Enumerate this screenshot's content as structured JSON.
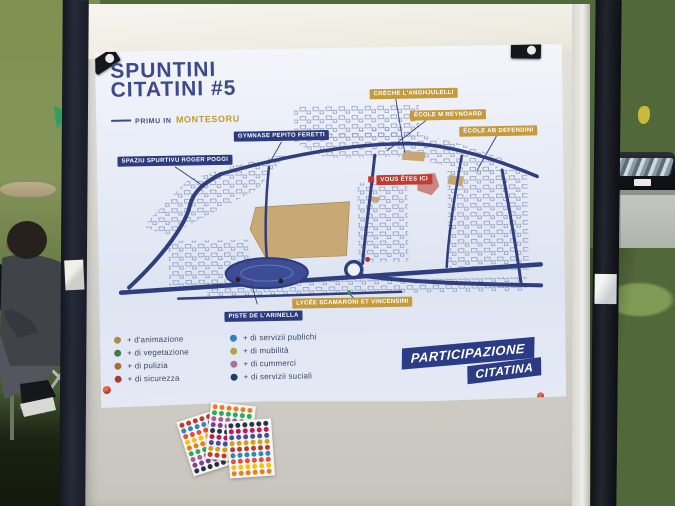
{
  "poster": {
    "title_line1": "SPUNTINI",
    "title_line2": "CITATINI #5",
    "subtitle_prefix": "PRIMU IN",
    "subtitle_place": "MONTESORU",
    "map_labels": [
      {
        "text": "SPAZIU SPURTIVU ROGER POGGI",
        "style": "blue"
      },
      {
        "text": "GYMNASE PEPITO FERETTI",
        "style": "blue"
      },
      {
        "text": "CRÈCHE L'ANGHJULELLI",
        "style": "gold"
      },
      {
        "text": "ÉCOLE M REYNOARD",
        "style": "gold"
      },
      {
        "text": "ÉCOLE AB DEFENDINI",
        "style": "gold"
      },
      {
        "text": "VOUS ÊTES ICI",
        "style": "red"
      },
      {
        "text": "LYCÉE SCAMARONI ET VINCENSINI",
        "style": "gold"
      },
      {
        "text": "PISTE DE L'ARINELLA",
        "style": "blue"
      }
    ],
    "legend_left": [
      {
        "label": "+ d'animazione",
        "color": "#b08948"
      },
      {
        "label": "+ di vegetazione",
        "color": "#3e7a4e"
      },
      {
        "label": "+ di pulizia",
        "color": "#ad6a33"
      },
      {
        "label": "+ di sicurezza",
        "color": "#a33c36"
      }
    ],
    "legend_right": [
      {
        "label": "+ di servizii publichi",
        "color": "#2e7fc2"
      },
      {
        "label": "+ di mubilità",
        "color": "#b3a23f"
      },
      {
        "label": "+ di cummerci",
        "color": "#a9719e"
      },
      {
        "label": "+ di servizii suciali",
        "color": "#1d3a6b"
      }
    ],
    "badge_line1": "PARTICIPAZIONE",
    "badge_line2": "CITATINA",
    "colors": {
      "navy_ink": "#2c3b7d",
      "title_blue": "#3c4a8c",
      "gold": "#c49a3c",
      "red_marker": "#c23d31",
      "track_blue": "#3c4d96",
      "zone_tan": "#c6a36a",
      "zone_red": "#c4766a"
    }
  },
  "stickers": {
    "palette": [
      "#c0392b",
      "#2e86c1",
      "#e74c3c",
      "#f1c40f",
      "#e67e22",
      "#27ae60",
      "#b05c9a",
      "#7d3f98",
      "#243447",
      "#c2185b",
      "#3f51a5",
      "#d4a017"
    ]
  }
}
